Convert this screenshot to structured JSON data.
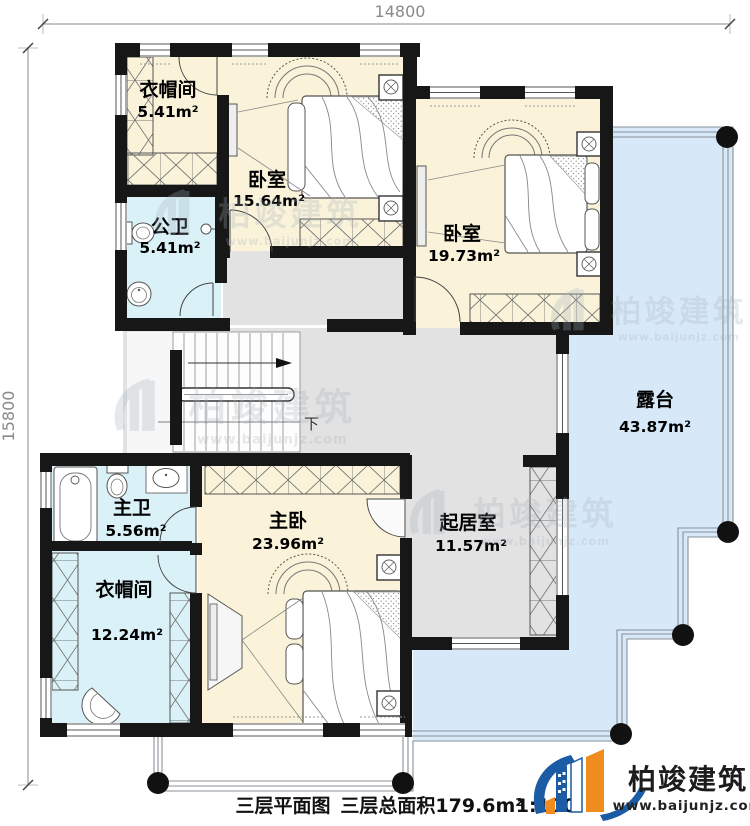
{
  "dimensions": {
    "top_width": "14800",
    "left_height": "15800"
  },
  "rooms": {
    "cloak1": {
      "name": "衣帽间",
      "area": "5.41m²"
    },
    "bed1": {
      "name": "卧室",
      "area": "15.64m²"
    },
    "bath1": {
      "name": "公卫",
      "area": "5.41m²"
    },
    "bed2": {
      "name": "卧室",
      "area": "19.73m²"
    },
    "terrace": {
      "name": "露台",
      "area": "43.87m²"
    },
    "bath2": {
      "name": "主卫",
      "area": "5.56m²"
    },
    "master": {
      "name": "主卧",
      "area": "23.96m²"
    },
    "living": {
      "name": "起居室",
      "area": "11.57m²"
    },
    "cloak2": {
      "name": "衣帽间",
      "area": "12.24m²"
    }
  },
  "stairs": {
    "down_label": "下"
  },
  "caption": {
    "plan_title": "三层平面图",
    "total_area": "三层总面积179.6m²",
    "scale": "1:100"
  },
  "brand": {
    "name": "柏竣建筑",
    "website": "www.baijunjz.com"
  },
  "watermark": {
    "name": "柏竣建筑",
    "website": "www.baijunjz.com"
  },
  "colors": {
    "wall": "#171717",
    "cream": "#faf3da",
    "aqua": "#daf1f8",
    "terrace": "#d7e9f8",
    "hall": "#e2e2e2",
    "brandblue": "#1b5ca5",
    "brandorange": "#ef8c1d",
    "wmgray": "#a7b0bb"
  }
}
